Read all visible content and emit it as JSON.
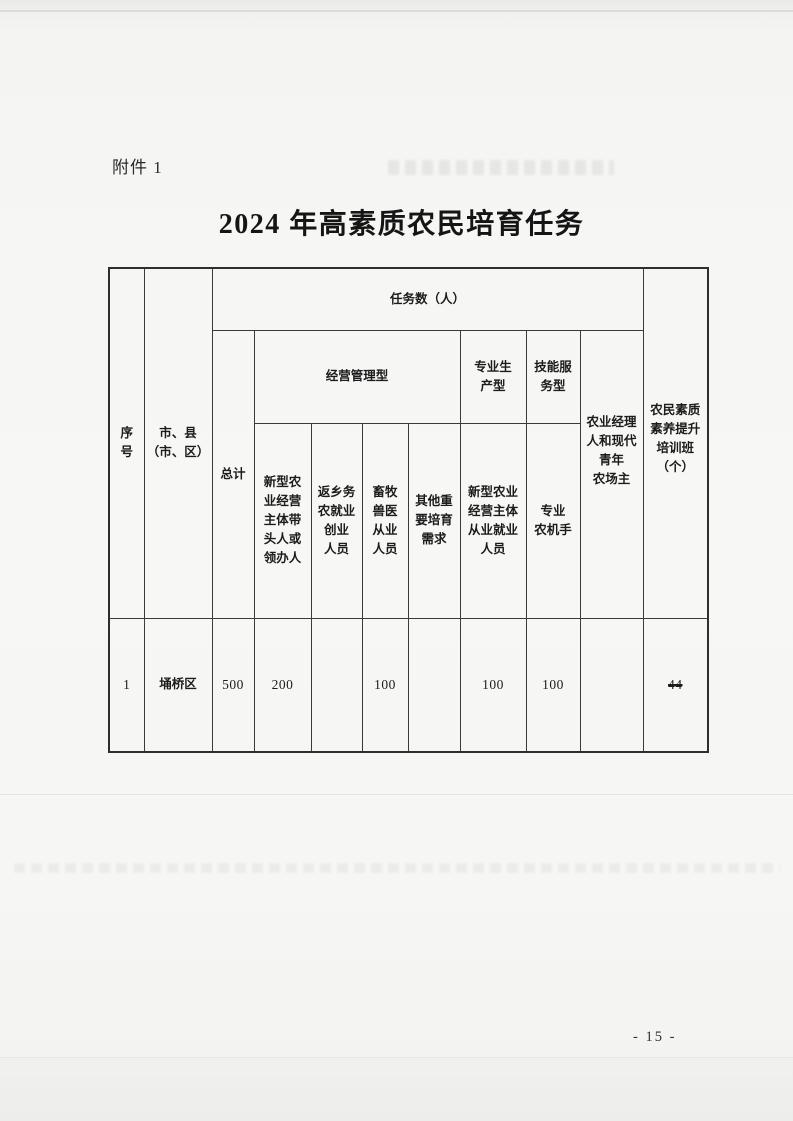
{
  "page": {
    "attachment_label": "附件 1",
    "title": "2024 年高素质农民培育任务",
    "page_number": "- 15 -"
  },
  "table": {
    "headers": {
      "seq": "序\n号",
      "region": "市、县\n（市、区）",
      "tasks_group": "任务数（人）",
      "total": "总计",
      "mgmt_group": "经营管理型",
      "prod_group": "专业生\n产型",
      "skill_group": "技能服\n务型",
      "manager": "农业经理\n人和现代\n青年\n农场主",
      "quality_class": "农民素质\n素养提升\n培训班\n（个）",
      "mgmt_sub1": "新型农\n业经营\n主体带\n头人或\n领办人",
      "mgmt_sub2": "返乡务\n农就业\n创业\n人员",
      "mgmt_sub3": "畜牧\n兽医\n从业\n人员",
      "mgmt_sub4": "其他重\n要培育\n需求",
      "prod_sub": "新型农业\n经营主体\n从业就业\n人员",
      "skill_sub": "专业\n农机手"
    },
    "rows": [
      {
        "seq": "1",
        "region": "埇桥区",
        "total": "500",
        "mgmt_sub1": "200",
        "mgmt_sub2": "",
        "mgmt_sub3": "100",
        "mgmt_sub4": "",
        "prod_sub": "100",
        "skill_sub": "100",
        "manager": "",
        "quality_class": "44",
        "quality_class_struck": true
      }
    ]
  },
  "colors": {
    "page_background": "#f6f6f4",
    "table_border": "#3a3a3a",
    "text": "#1c1c1c"
  }
}
